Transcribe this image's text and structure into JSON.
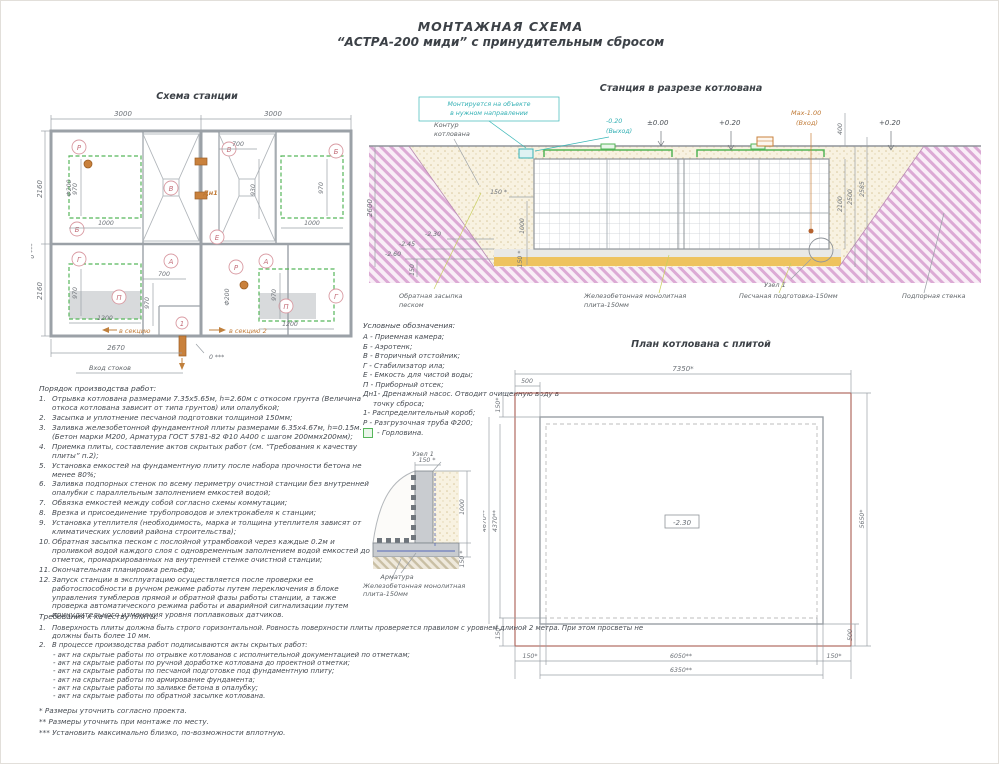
{
  "header": {
    "line1": "МОНТАЖНАЯ СХЕМА",
    "line2": "“АСТРА-200 миди” с принудительным сбросом"
  },
  "scheme": {
    "title": "Схема станции",
    "dim_top1": "3000",
    "dim_top2": "3000",
    "dim_left1": "2160",
    "dim_left2": "2160",
    "axis_left": "0 ***",
    "dim_bottom": "2670",
    "inlet_label": "Вход стоков",
    "axis_bottom": "0 ***",
    "to_section1": "в секцию",
    "to_section2": "в секцию 2",
    "lbl_P1": "Р",
    "lbl_phi1": "Ф200",
    "lbl_970a": "970",
    "lbl_B1": "Б",
    "lbl_1000a": "1000",
    "lbl_V1": "В",
    "lbl_700a": "700",
    "lbl_V2": "В",
    "lbl_B2": "Б",
    "lbl_Dn1": "Дн1",
    "lbl_930": "930",
    "lbl_970b": "970",
    "lbl_1000b": "1000",
    "lbl_E": "Е",
    "lbl_G1": "Г",
    "lbl_970c": "970",
    "lbl_P_otsek1": "П",
    "lbl_1200a": "1200",
    "lbl_A1": "А",
    "lbl_700b": "700",
    "lbl_970d": "970",
    "lbl_1": "1",
    "lbl_P2": "Р",
    "lbl_phi2": "Ф200",
    "lbl_A2": "А",
    "lbl_970e": "970",
    "lbl_P_otsek2": "П",
    "lbl_1200b": "1200",
    "lbl_G2": "Г"
  },
  "section": {
    "title": "Станция в разрезе котлована",
    "note1": "Монтируется на объекте",
    "note2": "в нужном направлении",
    "contour1": "Контур",
    "contour2": "котлована",
    "outlet_elev": "-0.20",
    "outlet_word": "(Выход)",
    "zero": "±0.00",
    "plus1": "+0.20",
    "plus2": "+0.20",
    "inlet_elev": "Max-1.00",
    "inlet_word": "(Вход)",
    "d400": "400",
    "d2100": "2100",
    "d2500": "2500",
    "d2585": "2585",
    "d2600": "2600",
    "d150t": "150 *",
    "d1000": "1000",
    "d150b": "150 *",
    "e230": "-2.30",
    "e245": "-2.45",
    "e260": "-2.60",
    "d150": "150",
    "backfill1": "Обратная засыпка",
    "backfill2": "песком",
    "slab1": "Железобетонная монолитная",
    "slab2": "плита-150мм",
    "sand": "Песчаная подготовка-150мм",
    "node": "Узел 1",
    "wall": "Подпорная стенка"
  },
  "legend": {
    "title": "Условные обозначения:",
    "items": [
      "А - Приемная камера;",
      "Б - Аэротенк;",
      "В - Вторичный отстойник;",
      "Г - Стабилизатор ила;",
      "Е - Емкость для чистой воды;",
      "П - Приборный отсек;",
      "Дн1- Дренажный насос. Отводит очищенную воду в точку сброса;",
      "1- Распределительный короб;",
      "Р - Разгрузочная труба Ф200;"
    ],
    "hatch_label": "- Горловина."
  },
  "pit_plan": {
    "title": "План котлована с плитой",
    "d7350": "7350*",
    "d500t": "500",
    "d150tl": "150*",
    "d4670": "4670**",
    "d4370": "4370**",
    "d5650": "5650*",
    "d500r": "500",
    "d150blv": "150*",
    "d150b1": "150*",
    "d6050": "6050**",
    "d150b2": "150*",
    "d6350": "6350**",
    "elev": "-2.30"
  },
  "node1": {
    "title": "Узел 1",
    "d150t": "150 *",
    "d1000": "1000",
    "d150b": "150 *",
    "rebar": "Арматура",
    "slab1": "Железобетонная монолитная",
    "slab2": "плита-150мм"
  },
  "work_order": {
    "title": "Порядок производства работ:",
    "nums": [
      "1.",
      "2.",
      "3.",
      "4.",
      "5.",
      "6.",
      "7.",
      "8.",
      "9.",
      "10.",
      "11.",
      "12."
    ],
    "items": [
      "Отрывка котлована размерами 7.35х5.65м, h=2.60м с откосом грунта (Величина откоса котлована зависит от типа грунтов) или опалубкой;",
      "Засыпка и уплотнение песчаной подготовки толщиной 150мм;",
      "Заливка железобетонной фундаментной плиты размерами 6.35х4.67м, h=0.15м. (Бетон марки М200, Арматура ГОСТ 5781-82 Ф10 А400 с шагом 200ммх200мм);",
      "Приемка плиты, составление актов скрытых работ (см. “Требования к качеству плиты” п.2);",
      "Установка емкостей на фундаментную плиту после набора прочности бетона не менее 80%;",
      "Заливка подпорных стенок по всему периметру очистной станции без внутренней опалубки с параллельным заполнением емкостей водой;",
      "Обвязка емкостей между собой согласно схемы коммутации;",
      "Врезка и присоединение трубопроводов и электрокабеля к станции;",
      "Установка утеплителя (необходимость, марка и толщина утеплителя зависят от климатических условий района строительства);",
      "Обратная засыпка песком с послойной утрамбовкой через каждые 0.2м и проливкой водой каждого слоя с одновременным заполнением водой емкостей до отметок, промаркированных на внутренней стенке очистной станции;",
      "Окончательная планировка рельефа;",
      "Запуск станции в эксплуатацию осуществляется после проверки ее работоспособности в ручном режиме работы путем переключения в блоке управления тумблеров прямой и обратной фазы работы станции, а также проверка автоматического режима работы и аварийной сигнализации путем принудительного изменения уровня поплавковых датчиков."
    ]
  },
  "plate_req": {
    "title": "Требования к качеству плиты:",
    "nums": [
      "1.",
      "2."
    ],
    "item1": "Поверхность плиты должна быть строго горизонтальной. Ровность поверхности плиты проверяется правилом с уровнем длиной 2 метра. При этом просветы не должны быть более 10 мм.",
    "item2": "В процессе производства работ подписываются акты скрытых работ:",
    "acts": [
      "- акт на скрытые работы по отрывке котлованов с исполнительной документацией по отметкам;",
      "- акт на скрытые работы по ручной доработке котлована до проектной отметки;",
      "- акт на скрытые работы по песчаной подготовке под фундаментную плиту;",
      "- акт на скрытые работы по армирование фундамента;",
      "- акт на скрытые работы по заливке бетона в опалубку;",
      "- акт на скрытые работы по обратной засыпке котлована."
    ]
  },
  "footnotes": [
    "*  Размеры уточнить согласно проекта.",
    "** Размеры уточнить при монтаже по месту.",
    "*** Установить максимально близко, по-возможности вплотную."
  ]
}
